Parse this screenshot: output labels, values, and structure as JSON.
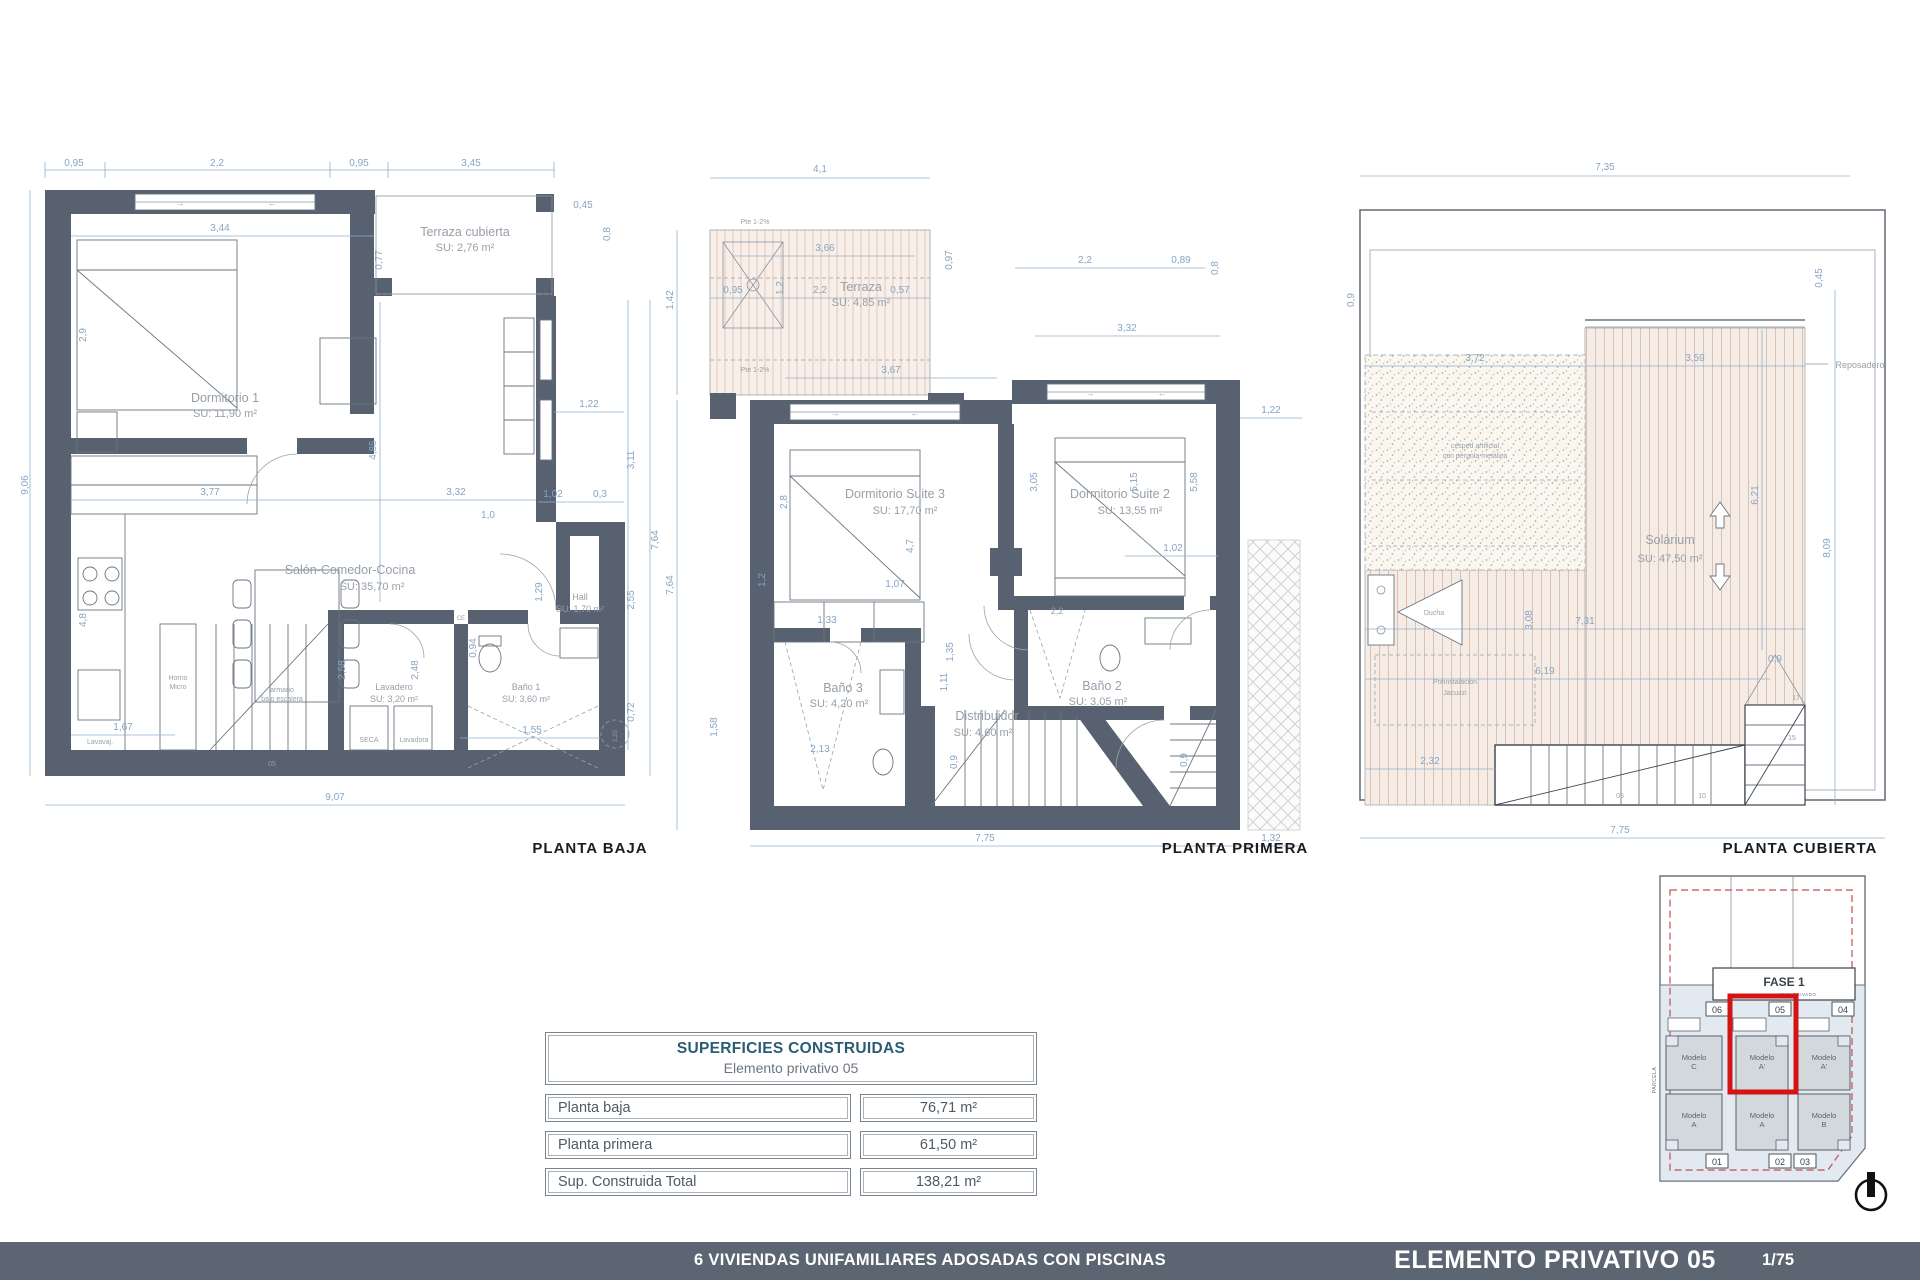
{
  "footer": {
    "project": "6 VIVIENDAS UNIFAMILIARES ADOSADAS CON PISCINAS",
    "sheet": "ELEMENTO PRIVATIVO 05",
    "page": "1/75"
  },
  "table": {
    "title": "SUPERFICIES CONSTRUIDAS",
    "subtitle": "Elemento privativo 05",
    "rows": [
      {
        "label": "Planta baja",
        "value": "76,71 m²"
      },
      {
        "label": "Planta primera",
        "value": "61,50 m²"
      },
      {
        "label": "Sup. Construida Total",
        "value": "138,21 m²"
      }
    ]
  },
  "plans": {
    "baja": {
      "label": "PLANTA BAJA",
      "rooms": [
        {
          "name": "Dormitorio 1",
          "su": "SU: 11,90 m²"
        },
        {
          "name": "Terraza cubierta",
          "su": "SU: 2,76 m²"
        },
        {
          "name": "Salón-Comedor-Cocina",
          "su": "SU: 35,70 m²"
        },
        {
          "name": "Hall",
          "su": "SU: 1,70 m²"
        },
        {
          "name": "Lavadero",
          "su": "SU: 3,20 m²"
        },
        {
          "name": "Baño 1",
          "su": "SU: 3,60 m²"
        }
      ],
      "annotations": [
        "armario",
        "bajo escalera",
        "SECA",
        "Lavadora",
        "Lavavaj.",
        "Horno",
        "Micro",
        "CE",
        "→",
        "←"
      ],
      "dims": [
        "0,95",
        "2,2",
        "0,95",
        "3,45",
        "3,44",
        "0,77",
        "0,45",
        "0,8",
        "9,06",
        "2,9",
        "4,8",
        "1,67",
        "3,77",
        "3,32",
        "1,0",
        "1,02",
        "0,3",
        "1,22",
        "3,11",
        "2,55",
        "0,72",
        "7,64",
        "4,85",
        "1,29",
        "0,94",
        "2,48",
        "2,58",
        "1,55",
        "9,07",
        "1,20",
        "05"
      ]
    },
    "primera": {
      "label": "PLANTA PRIMERA",
      "rooms": [
        {
          "name": "Terraza",
          "su": "SU: 4,85 m²"
        },
        {
          "name": "Dormitorio Suite 3",
          "su": "SU: 17,70 m²"
        },
        {
          "name": "Dormitorio Suite 2",
          "su": "SU: 13,55 m²"
        },
        {
          "name": "Baño 2",
          "su": "SU: 3,05 m²"
        },
        {
          "name": "Baño 3",
          "su": "SU: 4,20 m²"
        },
        {
          "name": "Distribuidor",
          "su": "SU: 4,60 m²"
        }
      ],
      "annotations": [
        "Pte 1-2%",
        "Pte 1-2%",
        "→",
        "←",
        "→",
        "←"
      ],
      "dims": [
        "4,1",
        "1,42",
        "3,66",
        "0,95",
        "1,2",
        "2,2",
        "0,57",
        "0,97",
        "2,2",
        "0,89",
        "0,8",
        "3,32",
        "3,67",
        "2,8",
        "3,05",
        "4,7",
        "1,07",
        "5,15",
        "5,58",
        "1,02",
        "1,22",
        "7,64",
        "1,2",
        "1,33",
        "1,35",
        "2,2",
        "1,11",
        "1,58",
        "2,13",
        "0,9",
        "0,9",
        "7,75",
        "1,32"
      ]
    },
    "cubierta": {
      "label": "PLANTA CUBIERTA",
      "room": {
        "name": "Solárium",
        "su": "SU: 47,50 m²"
      },
      "annotations": [
        "césped artificial",
        "con pérgola metálica",
        "Preinstalación",
        "Jacuzzi",
        "Ducha",
        "Reposadero"
      ],
      "dims": [
        "7,35",
        "0,45",
        "3,72",
        "3,59",
        "6,21",
        "8,09",
        "3,08",
        "7,31",
        "6,19",
        "0,9",
        "2,32",
        "7,75",
        "05",
        "10",
        "15",
        "17",
        "0,9"
      ]
    }
  },
  "site": {
    "fase": "FASE 1",
    "vial": "VIAL PRIVADO",
    "parcela": "PARCELA",
    "units": [
      {
        "plot": "06",
        "l1": "Modelo",
        "l2": "C"
      },
      {
        "plot": "05",
        "l1": "Modelo",
        "l2": "A'"
      },
      {
        "plot": "04",
        "l1": "Modelo",
        "l2": "A'"
      },
      {
        "plot": "01",
        "l1": "Modelo",
        "l2": "A"
      },
      {
        "plot": "02",
        "l1": "Modelo",
        "l2": "A"
      },
      {
        "plot": "03",
        "l1": "Modelo",
        "l2": "B"
      }
    ],
    "highlight_color": "#d21414"
  }
}
